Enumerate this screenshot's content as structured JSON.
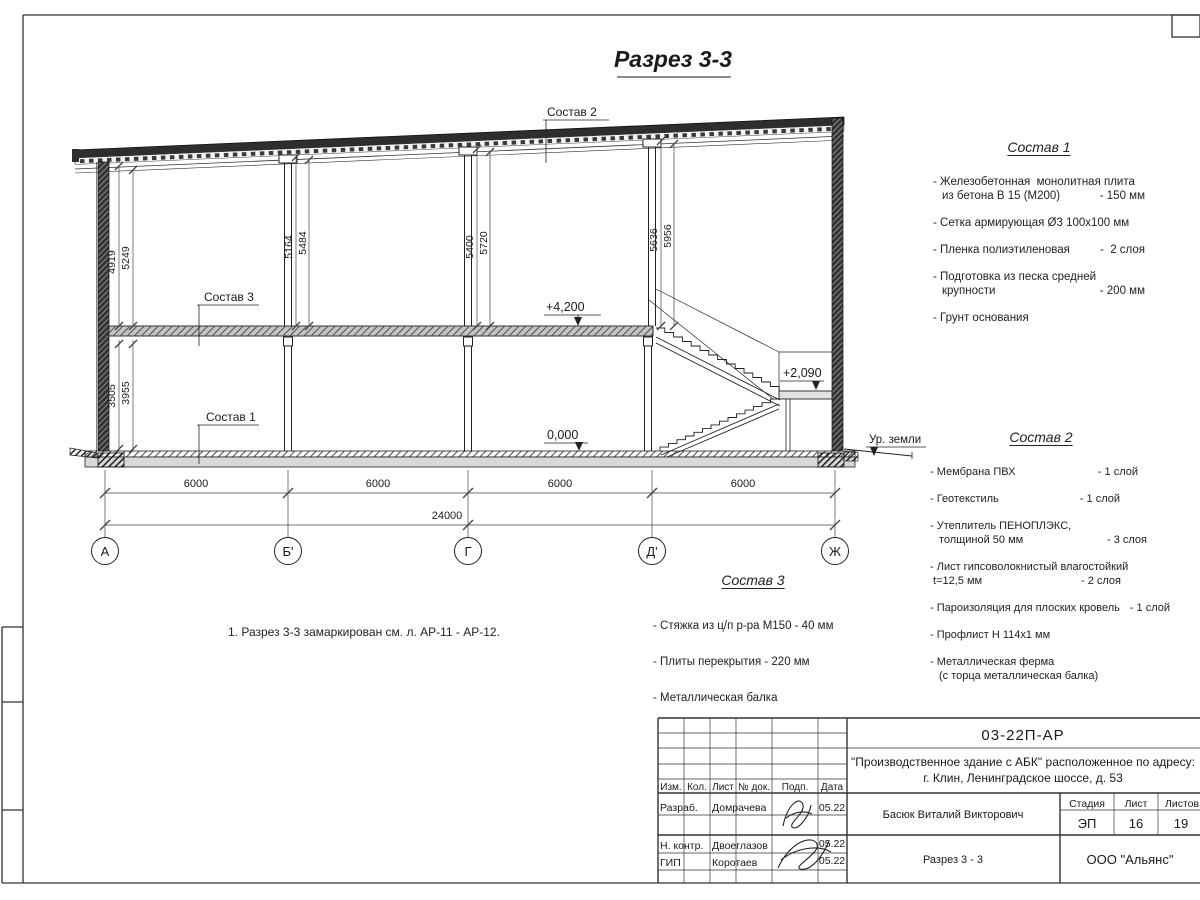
{
  "drawing": {
    "title": "Разрез 3-3",
    "elev_42": "+4,200",
    "elev_209": "+2,090",
    "elev_000": "0,000",
    "ground_label": "Ур. земли",
    "pairs": [
      {
        "a": "4919",
        "b": "5249"
      },
      {
        "a": "5164",
        "b": "5484"
      },
      {
        "a": "5400",
        "b": "5720"
      },
      {
        "a": "5636",
        "b": "5956"
      },
      {
        "a": "3505",
        "b": "3955"
      }
    ],
    "spans": [
      "6000",
      "6000",
      "6000",
      "6000"
    ],
    "total": "24000",
    "axes": [
      "А",
      "Б'",
      "Г",
      "Д'",
      "Ж"
    ]
  },
  "comp1": {
    "title": "Состав 1",
    "items": [
      {
        "l1": "- Железобетонная  монолитная плита",
        "l2": "из бетона В 15 (М200)",
        "v": "- 150 мм"
      },
      {
        "l1": "- Сетка армирующая Ø3 100х100 мм"
      },
      {
        "l1": "- Пленка полиэтиленовая",
        "v": "-  2 слоя"
      },
      {
        "l1": "- Подготовка из песка средней",
        "l2": "крупности",
        "v": "- 200 мм"
      },
      {
        "l1": "- Грунт основания"
      }
    ]
  },
  "comp2": {
    "title": "Состав 2",
    "items": [
      {
        "l1": "- Мембрана ПВХ",
        "v": "- 1 слой"
      },
      {
        "l1": "- Геотекстиль",
        "v": "- 1 слой"
      },
      {
        "l1": "- Утеплитель ПЕНОПЛЭКС,",
        "l2": "толщиной 50 мм",
        "v": "- 3 слоя"
      },
      {
        "l1": "- Лист гипсоволокнистый влагостойкий",
        "l2": "t=12,5 мм",
        "v": "- 2 слоя"
      },
      {
        "l1": "- Пароизоляция для плоских кровель",
        "v": "- 1 слой"
      },
      {
        "l1": "- Профлист Н 114х1 мм"
      },
      {
        "l1": "- Металлическая ферма",
        "l2": "(с торца металлическая балка)"
      }
    ]
  },
  "comp3": {
    "title": "Состав 3",
    "items": [
      {
        "l1": "- Стяжка из ц/п р-ра М150 - 40 мм"
      },
      {
        "l1": "- Плиты перекрытия - 220 мм"
      },
      {
        "l1": "- Металлическая балка"
      }
    ]
  },
  "note": {
    "text": "1. Разрез 3-3 замаркирован см. л. АР-11 - АР-12."
  },
  "tb": {
    "doc_number": "03-22П-АР",
    "project_line1": "\"Производственное здание с АБК\" расположенное по адресу:",
    "project_line2": "г. Клин, Ленинградское шоссе, д. 53",
    "col_izm": "Изм.",
    "col_kol": "Кол.",
    "col_list": "Лист",
    "col_ndok": "№ док.",
    "col_podp": "Подп.",
    "col_data": "Дата",
    "rows": [
      {
        "role": "Разраб.",
        "name": "Домрачева",
        "date": "05.22"
      },
      {
        "role": "Н. контр.",
        "name": "Двоеглазов",
        "date": "05.22"
      },
      {
        "role": "ГИП",
        "name": "Коротаев",
        "date": "05.22"
      }
    ],
    "chief": "Басюк Виталий Викторович",
    "sheet_title": "Разрез 3 - 3",
    "stage_label": "Стадия",
    "sheet_label": "Лист",
    "sheets_label": "Листов",
    "stage": "ЭП",
    "sheet": "16",
    "sheets": "19",
    "company": "ООО \"Альянс\""
  }
}
